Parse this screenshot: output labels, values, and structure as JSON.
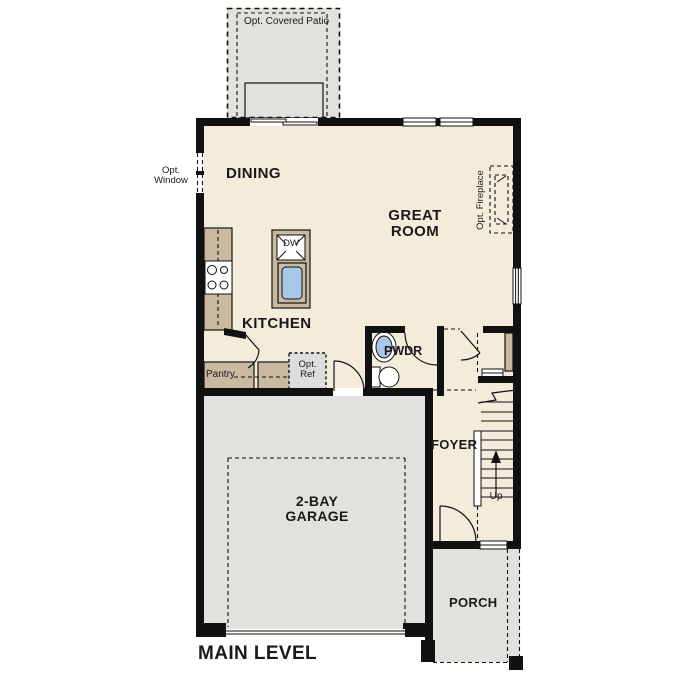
{
  "title": "MAIN LEVEL",
  "rooms": {
    "dining": "DINING",
    "great_room": "GREAT ROOM",
    "kitchen": "KITCHEN",
    "pantry": "Pantry",
    "powder": "PWDR",
    "foyer": "FOYER",
    "garage": "2-BAY GARAGE",
    "porch": "PORCH"
  },
  "options": {
    "covered_patio": "Opt. Covered Patio",
    "window": "Opt. Window",
    "ref": "Opt. Ref",
    "fireplace": "Opt. Fireplace"
  },
  "fixtures": {
    "dishwasher": "DW",
    "stairs_up": "Up"
  },
  "colors": {
    "wall": "#111111",
    "floor": "#f4ecdb",
    "exterior": "#e2e1de",
    "counter": "#c9b9a1",
    "sink": "#a9c7e7",
    "optional_fill": "#dddddd",
    "background": "#ffffff"
  }
}
